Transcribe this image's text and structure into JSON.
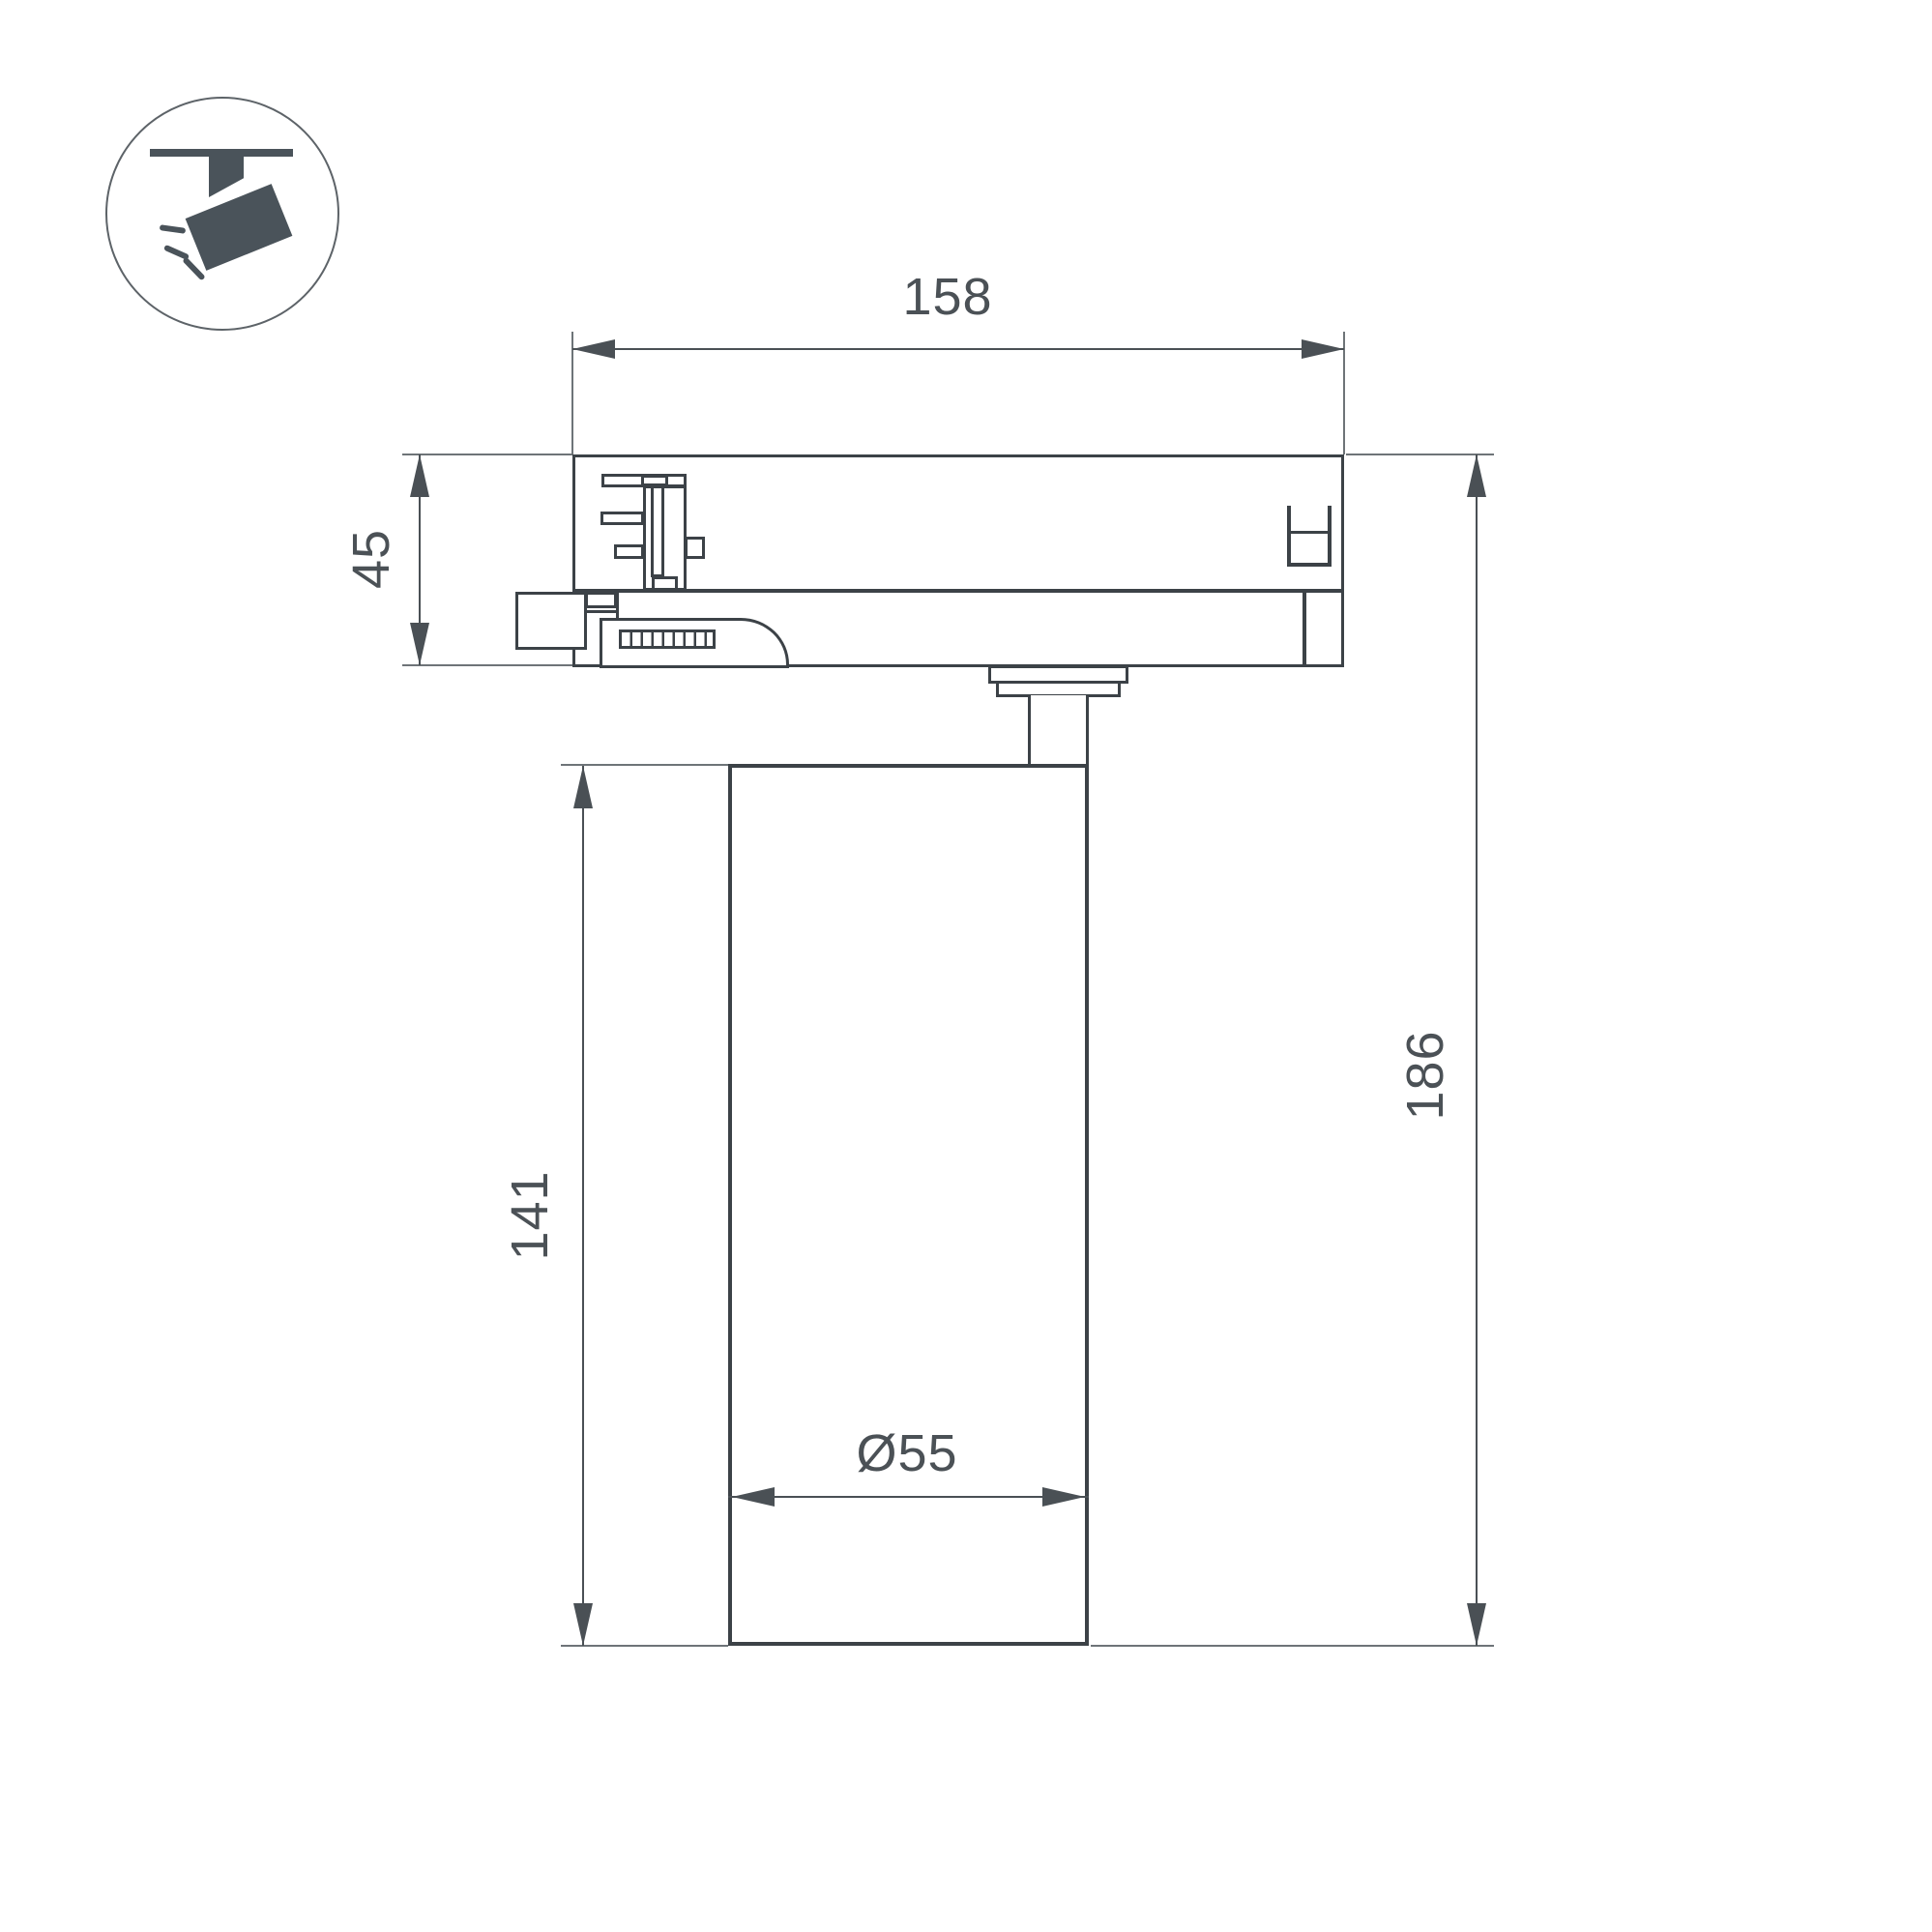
{
  "page": {
    "background": "#ffffff"
  },
  "icon": {
    "name": "track-spotlight-icon"
  },
  "dimensions": {
    "track_width": {
      "value": "158"
    },
    "adapter_height": {
      "value": "45"
    },
    "body_height": {
      "value": "141"
    },
    "total_height": {
      "value": "186"
    },
    "body_diameter": {
      "value": "Ø55"
    }
  },
  "colors": {
    "ink": "#3c4247",
    "dim": "#4a5055",
    "ext": "#6e7478",
    "text": "#4b5156",
    "icon": "#4a535a",
    "bg": "#ffffff"
  }
}
